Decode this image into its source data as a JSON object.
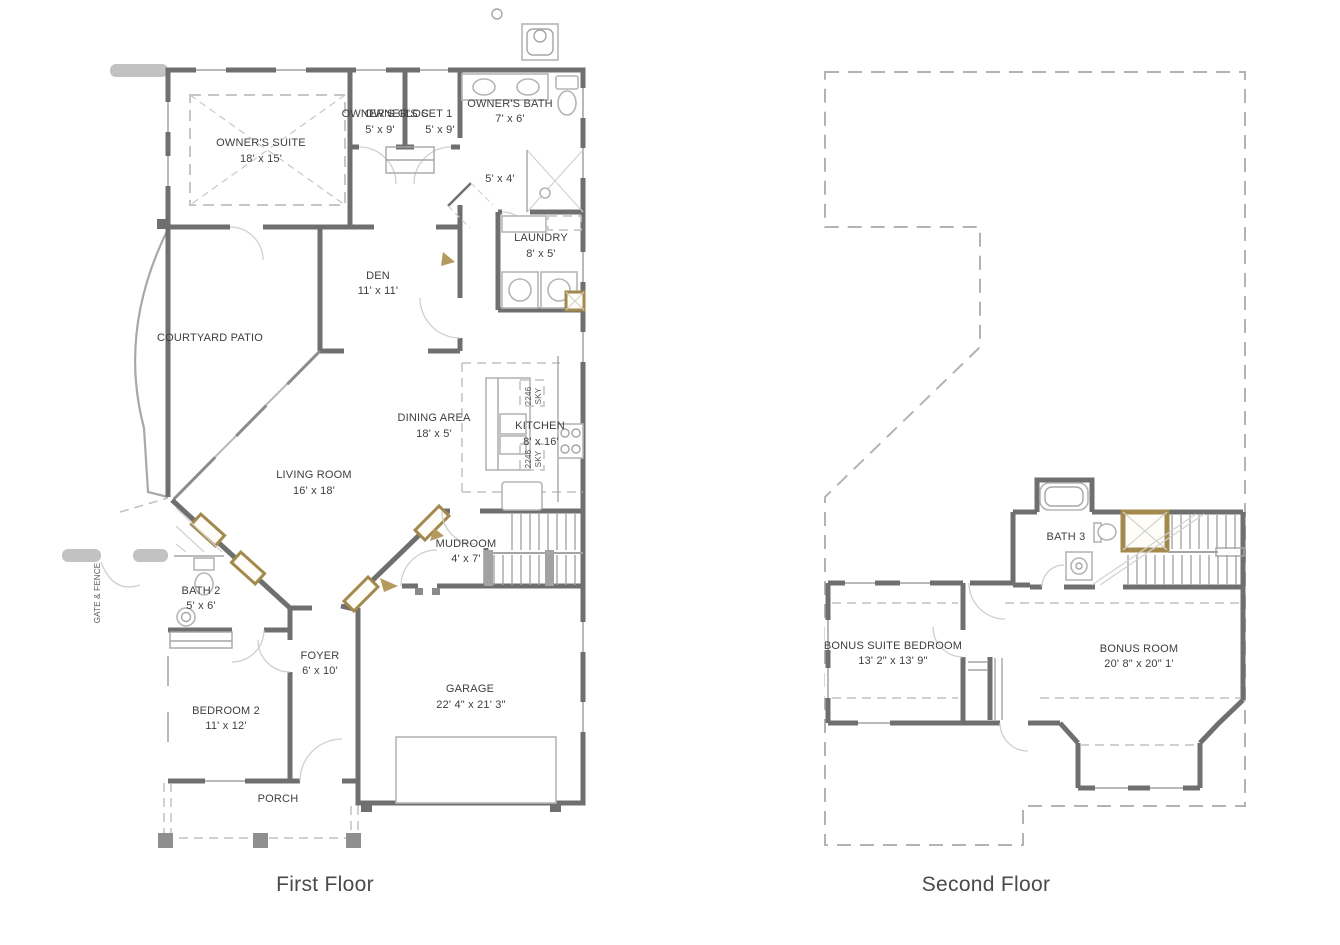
{
  "document": {
    "type": "house-floor-plan",
    "background": "#ffffff"
  },
  "colors": {
    "wall": "#6f6f6f",
    "light_line": "#b5b5b5",
    "dashed_line": "#c0c0c0",
    "accent_gold": "#a3894e",
    "text": "#3e3e3e",
    "title_text": "#4a4a4a",
    "gate_gray": "#c2c2c2"
  },
  "first_floor": {
    "title": "First Floor",
    "rooms": {
      "owners_suite": {
        "name": "OWNER'S SUITE",
        "dims": "18' x 15'"
      },
      "owners_closet_a": {
        "name": "OWNER'S C",
        "dims": "5' x 9'"
      },
      "owners_closet_b": {
        "name": "OWNER'S CLOSET 1",
        "dims": "5' x 9'"
      },
      "owners_bath": {
        "name": "OWNER'S BATH",
        "dims": "7' x 6'"
      },
      "shower": {
        "dims": "5' x 4'"
      },
      "laundry": {
        "name": "LAUNDRY",
        "dims": "8' x 5'"
      },
      "den": {
        "name": "DEN",
        "dims": "11' x 11'"
      },
      "courtyard": {
        "name": "COURTYARD PATIO"
      },
      "dining": {
        "name": "DINING AREA",
        "dims": "18' x 5'"
      },
      "kitchen": {
        "name": "KITCHEN",
        "dims": "8' x 16'"
      },
      "living": {
        "name": "LIVING ROOM",
        "dims": "16' x 18'"
      },
      "mudroom": {
        "name": "MUDROOM",
        "dims": "4' x 7'"
      },
      "bath2": {
        "name": "BATH 2",
        "dims": "5' x 6'"
      },
      "foyer": {
        "name": "FOYER",
        "dims": "6' x 10'"
      },
      "bedroom2": {
        "name": "BEDROOM 2",
        "dims": "11' x 12'"
      },
      "garage": {
        "name": "GARAGE",
        "dims": "22' 4\" x 21' 3\""
      },
      "porch": {
        "name": "PORCH"
      }
    },
    "annotations": {
      "gate_fence": "GATE & FENCE",
      "sky_code": "2246",
      "sky_label": "SKY"
    }
  },
  "second_floor": {
    "title": "Second Floor",
    "rooms": {
      "bath3": {
        "name": "BATH 3"
      },
      "bonus_suite_bedroom": {
        "name": "BONUS SUITE BEDROOM",
        "dims": "13' 2\" x 13' 9\""
      },
      "bonus_room": {
        "name": "BONUS ROOM",
        "dims": "20' 8\" x 20\" 1'"
      }
    }
  }
}
